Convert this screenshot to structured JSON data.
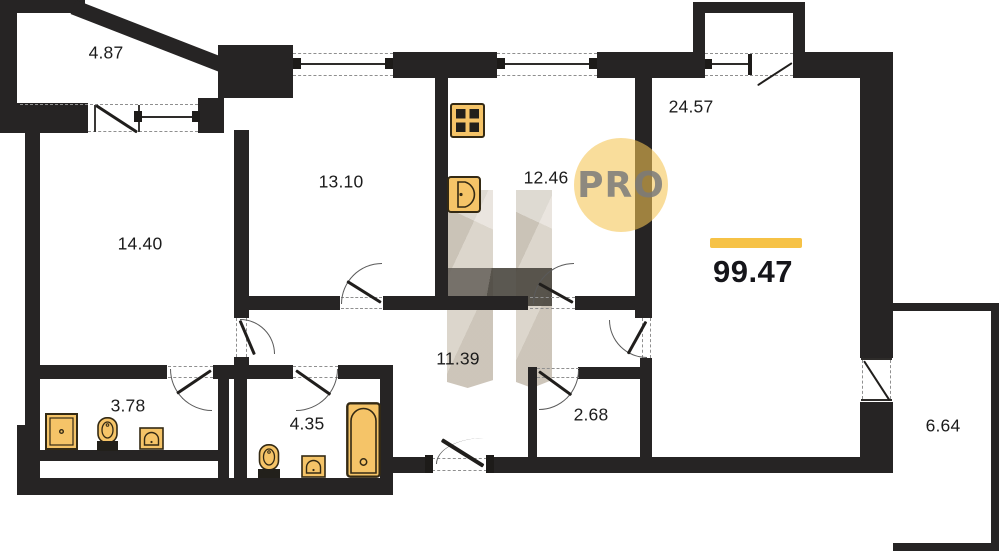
{
  "plan": {
    "watermark_text": "PRO",
    "total": {
      "area": "99.47"
    },
    "rooms": [
      {
        "name": "balcony-upper-left",
        "area": "4.87"
      },
      {
        "name": "room-upper-middle",
        "area": "13.10"
      },
      {
        "name": "kitchen",
        "area": "12.46"
      },
      {
        "name": "living-room",
        "area": "24.57"
      },
      {
        "name": "bedroom-left",
        "area": "14.40"
      },
      {
        "name": "hallway",
        "area": "11.39"
      },
      {
        "name": "bathroom-ensuite",
        "area": "3.78"
      },
      {
        "name": "bathroom-main",
        "area": "4.35"
      },
      {
        "name": "storage",
        "area": "2.68"
      },
      {
        "name": "balcony-right",
        "area": "6.64"
      }
    ],
    "fixtures": [
      "stove",
      "kitchen-sink",
      "shower",
      "toilet",
      "washbasin",
      "toilet",
      "washbasin",
      "bathtub"
    ],
    "colors": {
      "wall": "#262424",
      "fixture_fill": "#f5c468",
      "fixture_stroke": "#342a14",
      "fixture_dark": "#22201b",
      "accent_bar": "#f6c246",
      "watermark_circle": "#f4c553",
      "watermark_h_light": "#d8d1c5",
      "watermark_h_dark": "#57524a"
    }
  }
}
